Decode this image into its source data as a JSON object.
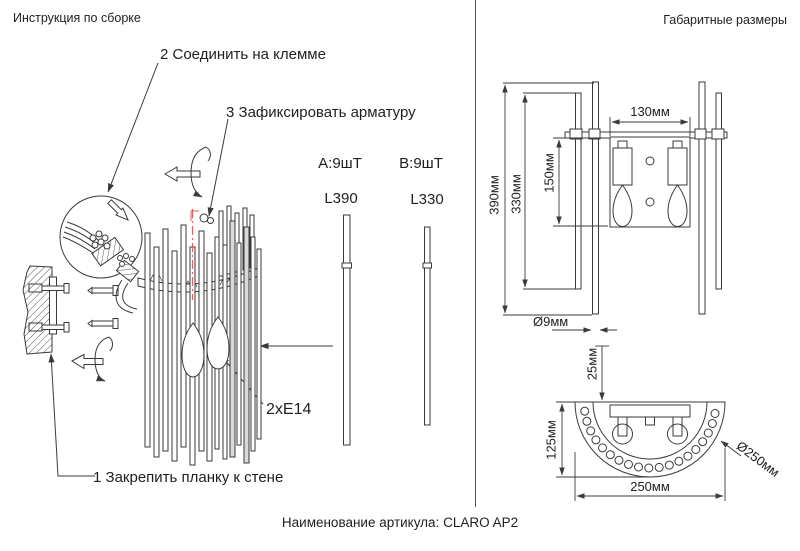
{
  "left_panel": {
    "title": "Инструкция по сборке",
    "step1": "1 Закрепить планку к стене",
    "step2": "2 Соединить на клемме",
    "step3": "3 Зафиксировать арматуру",
    "rod_a_qty": "А:9шТ",
    "rod_b_qty": "В:9шТ",
    "rod_a_len": "L390",
    "rod_b_len": "L330",
    "socket_label": "2хЕ14"
  },
  "right_panel": {
    "title": "Габаритные размеры",
    "dims": {
      "plate_width": "130мм",
      "plate_height": "150мм",
      "rod_long": "390мм",
      "rod_short": "330мм",
      "rod_diameter": "Ø9мм",
      "wall_offset": "25мм",
      "half_depth": "125мм",
      "total_width": "250мм",
      "total_diameter": "Ø250мм"
    }
  },
  "footer": {
    "article": "Наименование артикула: CLARO AP2"
  },
  "colors": {
    "line": "#3a3a3a",
    "accent_red": "#e06060",
    "background": "#ffffff"
  }
}
